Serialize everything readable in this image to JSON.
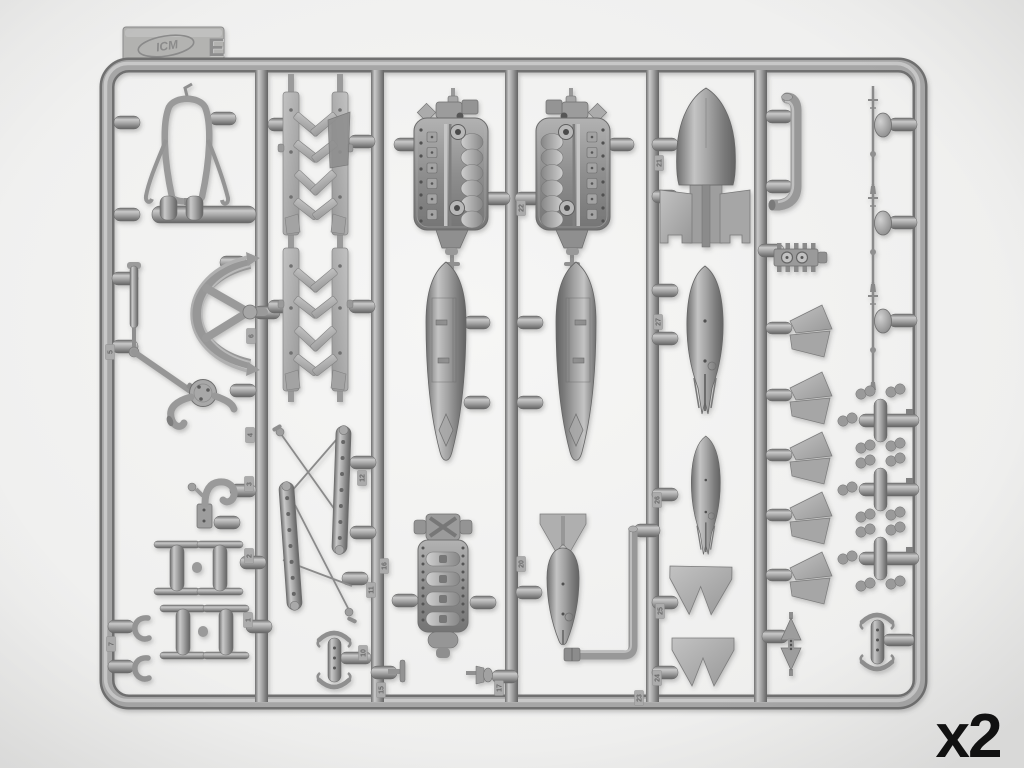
{
  "scene": {
    "description": "Gray injection-molded model kit sprue (runner) with aircraft parts photographed on a light background",
    "colors": {
      "background": "#eeeeed",
      "sprue": "#9e9e9e",
      "sprue_highlight": "#c9c9c9",
      "sprue_shadow": "#6a6a6a",
      "flat_part": "#b4b4b4",
      "label": "#111111"
    }
  },
  "tab": {
    "brand": "ICM",
    "letter": "E"
  },
  "quantity_label": "x2",
  "gate_tags": [
    {
      "n": "22",
      "x": 521,
      "y": 208
    },
    {
      "n": "21",
      "x": 659,
      "y": 163
    },
    {
      "n": "27",
      "x": 658,
      "y": 322
    },
    {
      "n": "26",
      "x": 657,
      "y": 500
    },
    {
      "n": "25",
      "x": 660,
      "y": 611
    },
    {
      "n": "24",
      "x": 657,
      "y": 678
    },
    {
      "n": "12",
      "x": 362,
      "y": 478
    },
    {
      "n": "16",
      "x": 384,
      "y": 566
    },
    {
      "n": "11",
      "x": 371,
      "y": 590
    },
    {
      "n": "10",
      "x": 363,
      "y": 653
    },
    {
      "n": "15",
      "x": 381,
      "y": 690
    },
    {
      "n": "17",
      "x": 499,
      "y": 688
    },
    {
      "n": "20",
      "x": 521,
      "y": 564
    },
    {
      "n": "23",
      "x": 639,
      "y": 698
    },
    {
      "n": "3",
      "x": 249,
      "y": 484
    },
    {
      "n": "4",
      "x": 250,
      "y": 435
    },
    {
      "n": "2",
      "x": 249,
      "y": 556
    },
    {
      "n": "1",
      "x": 248,
      "y": 620
    },
    {
      "n": "6",
      "x": 251,
      "y": 336
    },
    {
      "n": "5",
      "x": 110,
      "y": 352
    },
    {
      "n": "7",
      "x": 111,
      "y": 644
    }
  ],
  "parts": [
    {
      "name": "tubular-mount-frame",
      "count": 1
    },
    {
      "name": "spreader-bar",
      "count": 1
    },
    {
      "name": "half-wheel-yoke",
      "count": 1
    },
    {
      "name": "strut-rod",
      "count": 1
    },
    {
      "name": "pump-with-curved-pipe",
      "count": 1
    },
    {
      "name": "tow-hook",
      "count": 1
    },
    {
      "name": "i-beam-bracket",
      "count": 4
    },
    {
      "name": "c-clip",
      "count": 2
    },
    {
      "name": "framework-side-panel",
      "count": 4
    },
    {
      "name": "braced-strut-assembly",
      "count": 2
    },
    {
      "name": "saddle-yoke",
      "count": 2
    },
    {
      "name": "v12-engine-block-half",
      "count": 2
    },
    {
      "name": "engine-crankcase",
      "count": 1
    },
    {
      "name": "fuel-tank-half",
      "count": 2
    },
    {
      "name": "bomb-with-box-fin",
      "count": 1
    },
    {
      "name": "bomb-half-large",
      "count": 1
    },
    {
      "name": "bomb-half-small",
      "count": 1
    },
    {
      "name": "bomb-inverted-with-fins",
      "count": 1
    },
    {
      "name": "bomb-fin-plate",
      "count": 2
    },
    {
      "name": "l-shaped-pipe",
      "count": 1
    },
    {
      "name": "curved-intake-pipe",
      "count": 1
    },
    {
      "name": "radiator-block",
      "count": 1
    },
    {
      "name": "split-flap-scoop",
      "count": 5
    },
    {
      "name": "bowtie-bracket",
      "count": 1
    },
    {
      "name": "venturi-probe",
      "count": 3
    },
    {
      "name": "four-lobe-cross",
      "count": 3
    },
    {
      "name": "small-t-pin",
      "count": 1
    },
    {
      "name": "drain-plug",
      "count": 1
    }
  ]
}
